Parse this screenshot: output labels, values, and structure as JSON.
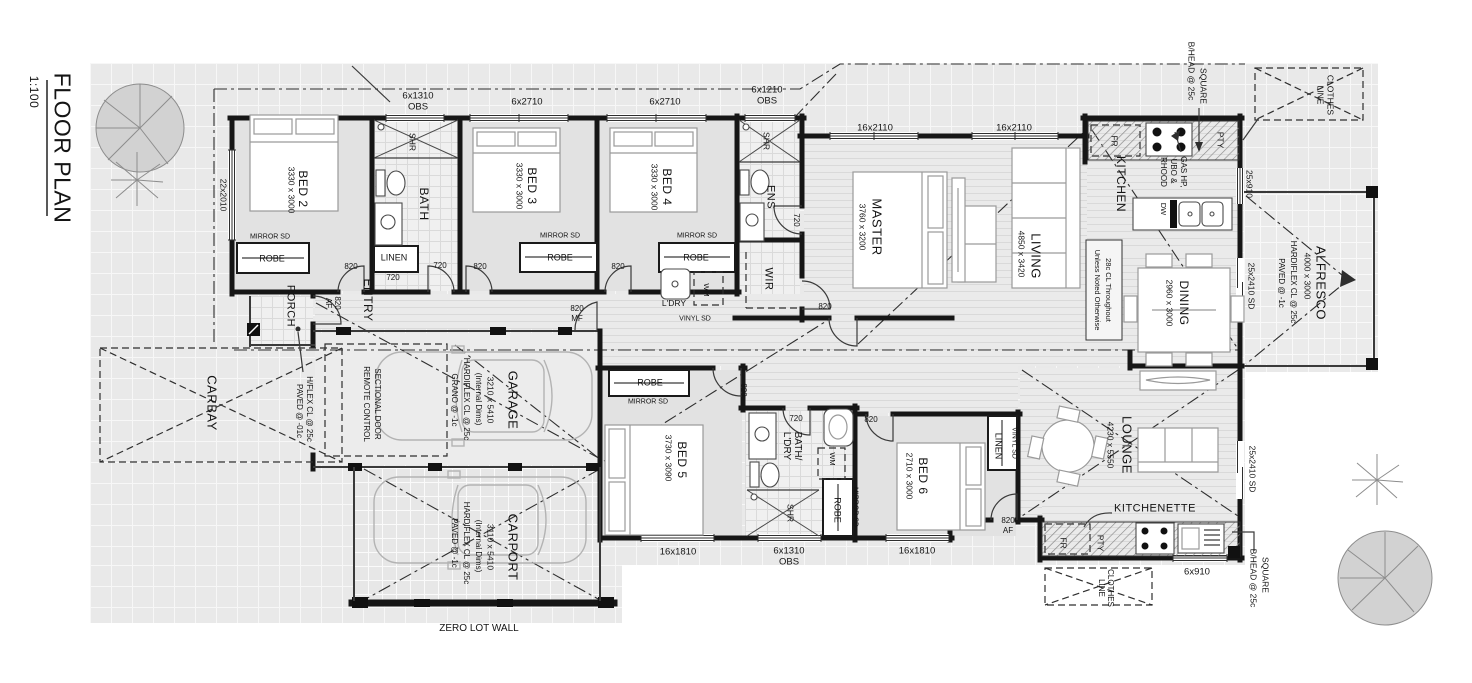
{
  "title": {
    "name": "FLOOR PLAN",
    "scale": "1:100"
  },
  "accent_colors": {
    "wall": "#161616",
    "floor_gray": "#e9e9e9",
    "paper": "#ffffff"
  },
  "labels": [
    {
      "id": "title",
      "text": "FLOOR PLAN",
      "x": 62,
      "y": 148,
      "r": 90,
      "s": 23
    },
    {
      "id": "scale",
      "text": "1:100",
      "x": 34,
      "y": 92,
      "r": 90,
      "s": 12
    },
    {
      "id": "win-22x2010",
      "text": "22x2010",
      "x": 223,
      "y": 195,
      "r": 90,
      "s": 8.5
    },
    {
      "id": "win-6x1310-top",
      "text": "6x1310",
      "x": 418,
      "y": 96,
      "r": 0,
      "s": 9.5
    },
    {
      "id": "win-obs-top",
      "text": "OBS",
      "x": 418,
      "y": 107,
      "r": 0,
      "s": 9.5
    },
    {
      "id": "win-6x2710-a",
      "text": "6x2710",
      "x": 527,
      "y": 102,
      "r": 0,
      "s": 9.5
    },
    {
      "id": "win-6x2710-b",
      "text": "6x2710",
      "x": 665,
      "y": 102,
      "r": 0,
      "s": 9.5
    },
    {
      "id": "win-6x1210",
      "text": "6x1210",
      "x": 767,
      "y": 90,
      "r": 0,
      "s": 9.5
    },
    {
      "id": "win-obs-ens",
      "text": "OBS",
      "x": 767,
      "y": 101,
      "r": 0,
      "s": 9.5
    },
    {
      "id": "win-16x2110-a",
      "text": "16x2110",
      "x": 875,
      "y": 128,
      "r": 0,
      "s": 9.5
    },
    {
      "id": "win-16x2110-b",
      "text": "16x2110",
      "x": 1014,
      "y": 128,
      "r": 0,
      "s": 9.5
    },
    {
      "id": "bhead-top-1",
      "text": "SQUARE",
      "x": 1203,
      "y": 86,
      "r": 90,
      "s": 8.5
    },
    {
      "id": "bhead-top-2",
      "text": "B/HEAD @ 25c",
      "x": 1191,
      "y": 71,
      "r": 90,
      "s": 8.5
    },
    {
      "id": "clothes-top-1",
      "text": "CLOTHES",
      "x": 1330,
      "y": 95,
      "r": 90,
      "s": 8.5
    },
    {
      "id": "clothes-top-2",
      "text": "LINE",
      "x": 1320,
      "y": 95,
      "r": 90,
      "s": 8.5
    },
    {
      "id": "win-25x910",
      "text": "25x910",
      "x": 1249,
      "y": 184,
      "r": 90,
      "s": 8.5
    },
    {
      "id": "fr-kitchen",
      "text": "FR",
      "x": 1114,
      "y": 141,
      "r": 90,
      "s": 8.5
    },
    {
      "id": "gas-1",
      "text": "GAS HP,",
      "x": 1183,
      "y": 172,
      "r": 90,
      "s": 8
    },
    {
      "id": "gas-2",
      "text": "UBO &",
      "x": 1173,
      "y": 171,
      "r": 90,
      "s": 8
    },
    {
      "id": "gas-3",
      "text": "RHOOD",
      "x": 1163,
      "y": 172,
      "r": 90,
      "s": 8
    },
    {
      "id": "pty-kitchen",
      "text": "PTY",
      "x": 1220,
      "y": 140,
      "r": 90,
      "s": 8.5
    },
    {
      "id": "kitchen",
      "text": "KITCHEN",
      "x": 1121,
      "y": 184,
      "r": 90,
      "s": 12
    },
    {
      "id": "dw",
      "text": "DW",
      "x": 1163,
      "y": 209,
      "r": 90,
      "s": 7.5
    },
    {
      "id": "dining",
      "text": "DINING",
      "x": 1184,
      "y": 303,
      "r": 90,
      "s": 12
    },
    {
      "id": "dining-dims",
      "text": "2960 x 3000",
      "x": 1169,
      "y": 303,
      "r": 90,
      "s": 8.5
    },
    {
      "id": "living",
      "text": "LIVING",
      "x": 1036,
      "y": 256,
      "r": 90,
      "s": 13
    },
    {
      "id": "living-dims",
      "text": "4850 x 3420",
      "x": 1021,
      "y": 254,
      "r": 90,
      "s": 8.5
    },
    {
      "id": "note-1",
      "text": "28c CL Throughout",
      "x": 1108,
      "y": 290,
      "r": 90,
      "s": 7.5
    },
    {
      "id": "note-2",
      "text": "Unless Noted Otherwise",
      "x": 1097,
      "y": 290,
      "r": 90,
      "s": 7.5
    },
    {
      "id": "master",
      "text": "MASTER",
      "x": 877,
      "y": 227,
      "r": 90,
      "s": 13
    },
    {
      "id": "master-dims",
      "text": "3760 x 3200",
      "x": 862,
      "y": 227,
      "r": 90,
      "s": 8.5
    },
    {
      "id": "wir",
      "text": "WIR",
      "x": 768,
      "y": 279,
      "r": 90,
      "s": 11
    },
    {
      "id": "ens",
      "text": "ENS",
      "x": 770,
      "y": 197,
      "r": 90,
      "s": 11
    },
    {
      "id": "shr-ens",
      "text": "SHR",
      "x": 766,
      "y": 141,
      "r": 90,
      "s": 8.5
    },
    {
      "id": "door-720-ens",
      "text": "720",
      "x": 796,
      "y": 220,
      "r": 90,
      "s": 8
    },
    {
      "id": "bath",
      "text": "BATH",
      "x": 424,
      "y": 204,
      "r": 90,
      "s": 12
    },
    {
      "id": "shr-bath",
      "text": "SHR",
      "x": 412,
      "y": 142,
      "r": 90,
      "s": 8.5
    },
    {
      "id": "bed2",
      "text": "BED 2",
      "x": 303,
      "y": 189,
      "r": 90,
      "s": 12
    },
    {
      "id": "bed2-dims",
      "text": "3330 x 3000",
      "x": 291,
      "y": 190,
      "r": 90,
      "s": 8.5
    },
    {
      "id": "bed3",
      "text": "BED 3",
      "x": 532,
      "y": 186,
      "r": 90,
      "s": 12
    },
    {
      "id": "bed3-dims",
      "text": "3330 x 3000",
      "x": 519,
      "y": 186,
      "r": 90,
      "s": 8.5
    },
    {
      "id": "bed4",
      "text": "BED 4",
      "x": 667,
      "y": 187,
      "r": 90,
      "s": 12
    },
    {
      "id": "bed4-dims",
      "text": "3330 x 3000",
      "x": 654,
      "y": 187,
      "r": 90,
      "s": 8.5
    },
    {
      "id": "mirror-bed2",
      "text": "MIRROR SD",
      "x": 270,
      "y": 237,
      "r": 0,
      "s": 7
    },
    {
      "id": "robe-bed2",
      "text": "ROBE",
      "x": 272,
      "y": 259,
      "r": 0,
      "s": 9
    },
    {
      "id": "mirror-bed3",
      "text": "MIRROR SD",
      "x": 560,
      "y": 236,
      "r": 0,
      "s": 7
    },
    {
      "id": "robe-bed3",
      "text": "ROBE",
      "x": 560,
      "y": 258,
      "r": 0,
      "s": 9
    },
    {
      "id": "mirror-bed4",
      "text": "MIRROR SD",
      "x": 697,
      "y": 236,
      "r": 0,
      "s": 7
    },
    {
      "id": "robe-bed4",
      "text": "ROBE",
      "x": 696,
      "y": 258,
      "r": 0,
      "s": 9
    },
    {
      "id": "linen-entry",
      "text": "LINEN",
      "x": 394,
      "y": 258,
      "r": 0,
      "s": 9
    },
    {
      "id": "door-820-bed2",
      "text": "820",
      "x": 351,
      "y": 267,
      "r": 0,
      "s": 8
    },
    {
      "id": "dim-720-entry",
      "text": "720",
      "x": 393,
      "y": 278,
      "r": 0,
      "s": 8
    },
    {
      "id": "door-720-bath",
      "text": "720",
      "x": 440,
      "y": 266,
      "r": 0,
      "s": 8
    },
    {
      "id": "door-820-bed3",
      "text": "820",
      "x": 480,
      "y": 267,
      "r": 0,
      "s": 8
    },
    {
      "id": "door-820-bed4",
      "text": "820",
      "x": 618,
      "y": 267,
      "r": 0,
      "s": 8
    },
    {
      "id": "porch",
      "text": "PORCH",
      "x": 290,
      "y": 306,
      "r": 90,
      "s": 11
    },
    {
      "id": "door-820-front",
      "text": "820",
      "x": 337,
      "y": 303,
      "r": 90,
      "s": 8
    },
    {
      "id": "door-af-front",
      "text": "AF",
      "x": 328,
      "y": 303,
      "r": 90,
      "s": 8
    },
    {
      "id": "entry",
      "text": "ENTRY",
      "x": 368,
      "y": 300,
      "r": 90,
      "s": 12
    },
    {
      "id": "dim-820-mf",
      "text": "820",
      "x": 577,
      "y": 309,
      "r": 0,
      "s": 8
    },
    {
      "id": "dim-mf",
      "text": "MF",
      "x": 577,
      "y": 319,
      "r": 0,
      "s": 8
    },
    {
      "id": "ldry",
      "text": "L'DRY",
      "x": 674,
      "y": 303,
      "r": 0,
      "s": 8.5
    },
    {
      "id": "vinyl-sd-1",
      "text": "VINYL SD",
      "x": 695,
      "y": 319,
      "r": 0,
      "s": 7
    },
    {
      "id": "wm-1",
      "text": "WM",
      "x": 706,
      "y": 290,
      "r": 90,
      "s": 7.5
    },
    {
      "id": "door-820-master",
      "text": "820",
      "x": 825,
      "y": 307,
      "r": 0,
      "s": 8
    },
    {
      "id": "alfresco",
      "text": "ALFRESCO",
      "x": 1321,
      "y": 283,
      "r": 90,
      "s": 13
    },
    {
      "id": "alfresco-dims",
      "text": "4000 x 3000",
      "x": 1307,
      "y": 276,
      "r": 90,
      "s": 8.5
    },
    {
      "id": "alfresco-note1",
      "text": "HARDIFLEX CL @ 25c",
      "x": 1293,
      "y": 282,
      "r": 90,
      "s": 8
    },
    {
      "id": "alfresco-note2",
      "text": "PAVED @ -1c",
      "x": 1281,
      "y": 283,
      "r": 90,
      "s": 8
    },
    {
      "id": "sd-dining",
      "text": "25x2410 SD",
      "x": 1251,
      "y": 286,
      "r": 90,
      "s": 8.5
    },
    {
      "id": "sd-lounge",
      "text": "25x2410 SD",
      "x": 1252,
      "y": 469,
      "r": 90,
      "s": 8.5
    },
    {
      "id": "carbay-note1",
      "text": "H/FLEX CL @ 25c",
      "x": 309,
      "y": 409,
      "r": 90,
      "s": 8
    },
    {
      "id": "carbay-note2",
      "text": "PAVED @ -01c",
      "x": 299,
      "y": 411,
      "r": 90,
      "s": 8
    },
    {
      "id": "carbay",
      "text": "CARBAY",
      "x": 212,
      "y": 403,
      "r": 90,
      "s": 13
    },
    {
      "id": "garage-door1",
      "text": "REMOTE CONTROL",
      "x": 366,
      "y": 404,
      "r": 90,
      "s": 8
    },
    {
      "id": "garage-door2",
      "text": "SECTIONAL DOOR",
      "x": 377,
      "y": 404,
      "r": 90,
      "s": 8
    },
    {
      "id": "garage",
      "text": "GARAGE",
      "x": 513,
      "y": 400,
      "r": 90,
      "s": 13
    },
    {
      "id": "garage-dims",
      "text": "3210 x 5410",
      "x": 490,
      "y": 400,
      "r": 90,
      "s": 8.5
    },
    {
      "id": "garage-int",
      "text": "(Internal Dims)",
      "x": 478,
      "y": 399,
      "r": 90,
      "s": 8
    },
    {
      "id": "garage-note1",
      "text": "HARDIFLEX CL @ 25c",
      "x": 466,
      "y": 399,
      "r": 90,
      "s": 8
    },
    {
      "id": "garage-note2",
      "text": "GRANO @ -1c",
      "x": 454,
      "y": 400,
      "r": 90,
      "s": 8
    },
    {
      "id": "carport",
      "text": "CARPORT",
      "x": 513,
      "y": 547,
      "r": 90,
      "s": 13
    },
    {
      "id": "carport-dims",
      "text": "3110 x 5410",
      "x": 490,
      "y": 547,
      "r": 90,
      "s": 8.5
    },
    {
      "id": "carport-int",
      "text": "(Internal Dims)",
      "x": 478,
      "y": 546,
      "r": 90,
      "s": 8
    },
    {
      "id": "carport-note1",
      "text": "HARDIFLEX CL @ 25c",
      "x": 466,
      "y": 543,
      "r": 90,
      "s": 8
    },
    {
      "id": "carport-note2",
      "text": "PAVED @ -1c",
      "x": 454,
      "y": 543,
      "r": 90,
      "s": 8
    },
    {
      "id": "zero-lot-wall",
      "text": "ZERO LOT WALL",
      "x": 479,
      "y": 629,
      "r": 0,
      "s": 10
    },
    {
      "id": "bed5",
      "text": "BED 5",
      "x": 682,
      "y": 460,
      "r": 90,
      "s": 12
    },
    {
      "id": "bed5-dims",
      "text": "3730 x 3090",
      "x": 668,
      "y": 458,
      "r": 90,
      "s": 8.5
    },
    {
      "id": "robe-bed5",
      "text": "ROBE",
      "x": 650,
      "y": 383,
      "r": 0,
      "s": 9
    },
    {
      "id": "mirror-bed5",
      "text": "MIRROR SD",
      "x": 648,
      "y": 402,
      "r": 0,
      "s": 7
    },
    {
      "id": "door-820-bed5",
      "text": "820",
      "x": 743,
      "y": 390,
      "r": 90,
      "s": 8
    },
    {
      "id": "bathldry-1",
      "text": "BATH/",
      "x": 797,
      "y": 446,
      "r": 90,
      "s": 10
    },
    {
      "id": "bathldry-2",
      "text": "L'DRY",
      "x": 786,
      "y": 446,
      "r": 90,
      "s": 10
    },
    {
      "id": "door-720-bathldry",
      "text": "720",
      "x": 796,
      "y": 419,
      "r": 0,
      "s": 8
    },
    {
      "id": "door-820-bed6",
      "text": "820",
      "x": 871,
      "y": 420,
      "r": 0,
      "s": 8
    },
    {
      "id": "wm-2",
      "text": "WM",
      "x": 832,
      "y": 459,
      "r": 90,
      "s": 7.5
    },
    {
      "id": "robe-bathldry",
      "text": "ROBE",
      "x": 837,
      "y": 510,
      "r": 90,
      "s": 9
    },
    {
      "id": "mirror-bathldry",
      "text": "MIRROR SD",
      "x": 855,
      "y": 507,
      "r": 90,
      "s": 7
    },
    {
      "id": "shr-bathldry",
      "text": "SHR",
      "x": 790,
      "y": 513,
      "r": 90,
      "s": 8.5
    },
    {
      "id": "win-16x1810-a",
      "text": "16x1810",
      "x": 678,
      "y": 552,
      "r": 0,
      "s": 9.5
    },
    {
      "id": "win-6x1310-b",
      "text": "6x1310",
      "x": 789,
      "y": 551,
      "r": 0,
      "s": 9.5
    },
    {
      "id": "win-obs-b",
      "text": "OBS",
      "x": 789,
      "y": 562,
      "r": 0,
      "s": 9.5
    },
    {
      "id": "win-16x1810-b",
      "text": "16x1810",
      "x": 917,
      "y": 551,
      "r": 0,
      "s": 9.5
    },
    {
      "id": "bed6",
      "text": "BED 6",
      "x": 923,
      "y": 476,
      "r": 90,
      "s": 12
    },
    {
      "id": "bed6-dims",
      "text": "2710 x 3000",
      "x": 909,
      "y": 476,
      "r": 90,
      "s": 8.5
    },
    {
      "id": "linen-bed6",
      "text": "LINEN",
      "x": 998,
      "y": 446,
      "r": 90,
      "s": 9
    },
    {
      "id": "vinyl-sd-2",
      "text": "VINYL SD",
      "x": 1014,
      "y": 443,
      "r": 90,
      "s": 7
    },
    {
      "id": "lounge",
      "text": "LOUNGE",
      "x": 1127,
      "y": 445,
      "r": 90,
      "s": 13
    },
    {
      "id": "lounge-dims",
      "text": "4230 x 5550",
      "x": 1110,
      "y": 445,
      "r": 90,
      "s": 8.5
    },
    {
      "id": "kitchenette",
      "text": "KITCHENETTE",
      "x": 1155,
      "y": 509,
      "r": 0,
      "s": 11
    },
    {
      "id": "fr-kitchenette",
      "text": "FR",
      "x": 1063,
      "y": 543,
      "r": 90,
      "s": 8.5
    },
    {
      "id": "pty-kitchenette",
      "text": "PTY",
      "x": 1100,
      "y": 543,
      "r": 90,
      "s": 8.5
    },
    {
      "id": "win-6x910",
      "text": "6x910",
      "x": 1197,
      "y": 572,
      "r": 0,
      "s": 9.5
    },
    {
      "id": "bhead-bot-1",
      "text": "SQUARE",
      "x": 1265,
      "y": 575,
      "r": 90,
      "s": 8.5
    },
    {
      "id": "bhead-bot-2",
      "text": "B/HEAD @ 25c",
      "x": 1253,
      "y": 578,
      "r": 90,
      "s": 8.5
    },
    {
      "id": "clothes-bot-1",
      "text": "CLOTHES",
      "x": 1110,
      "y": 588,
      "r": 90,
      "s": 8
    },
    {
      "id": "clothes-bot-2",
      "text": "LINE",
      "x": 1101,
      "y": 588,
      "r": 90,
      "s": 8
    },
    {
      "id": "door-820-lounge",
      "text": "820",
      "x": 1008,
      "y": 521,
      "r": 0,
      "s": 8
    },
    {
      "id": "door-af-lounge",
      "text": "AF",
      "x": 1008,
      "y": 531,
      "r": 0,
      "s": 8
    }
  ]
}
